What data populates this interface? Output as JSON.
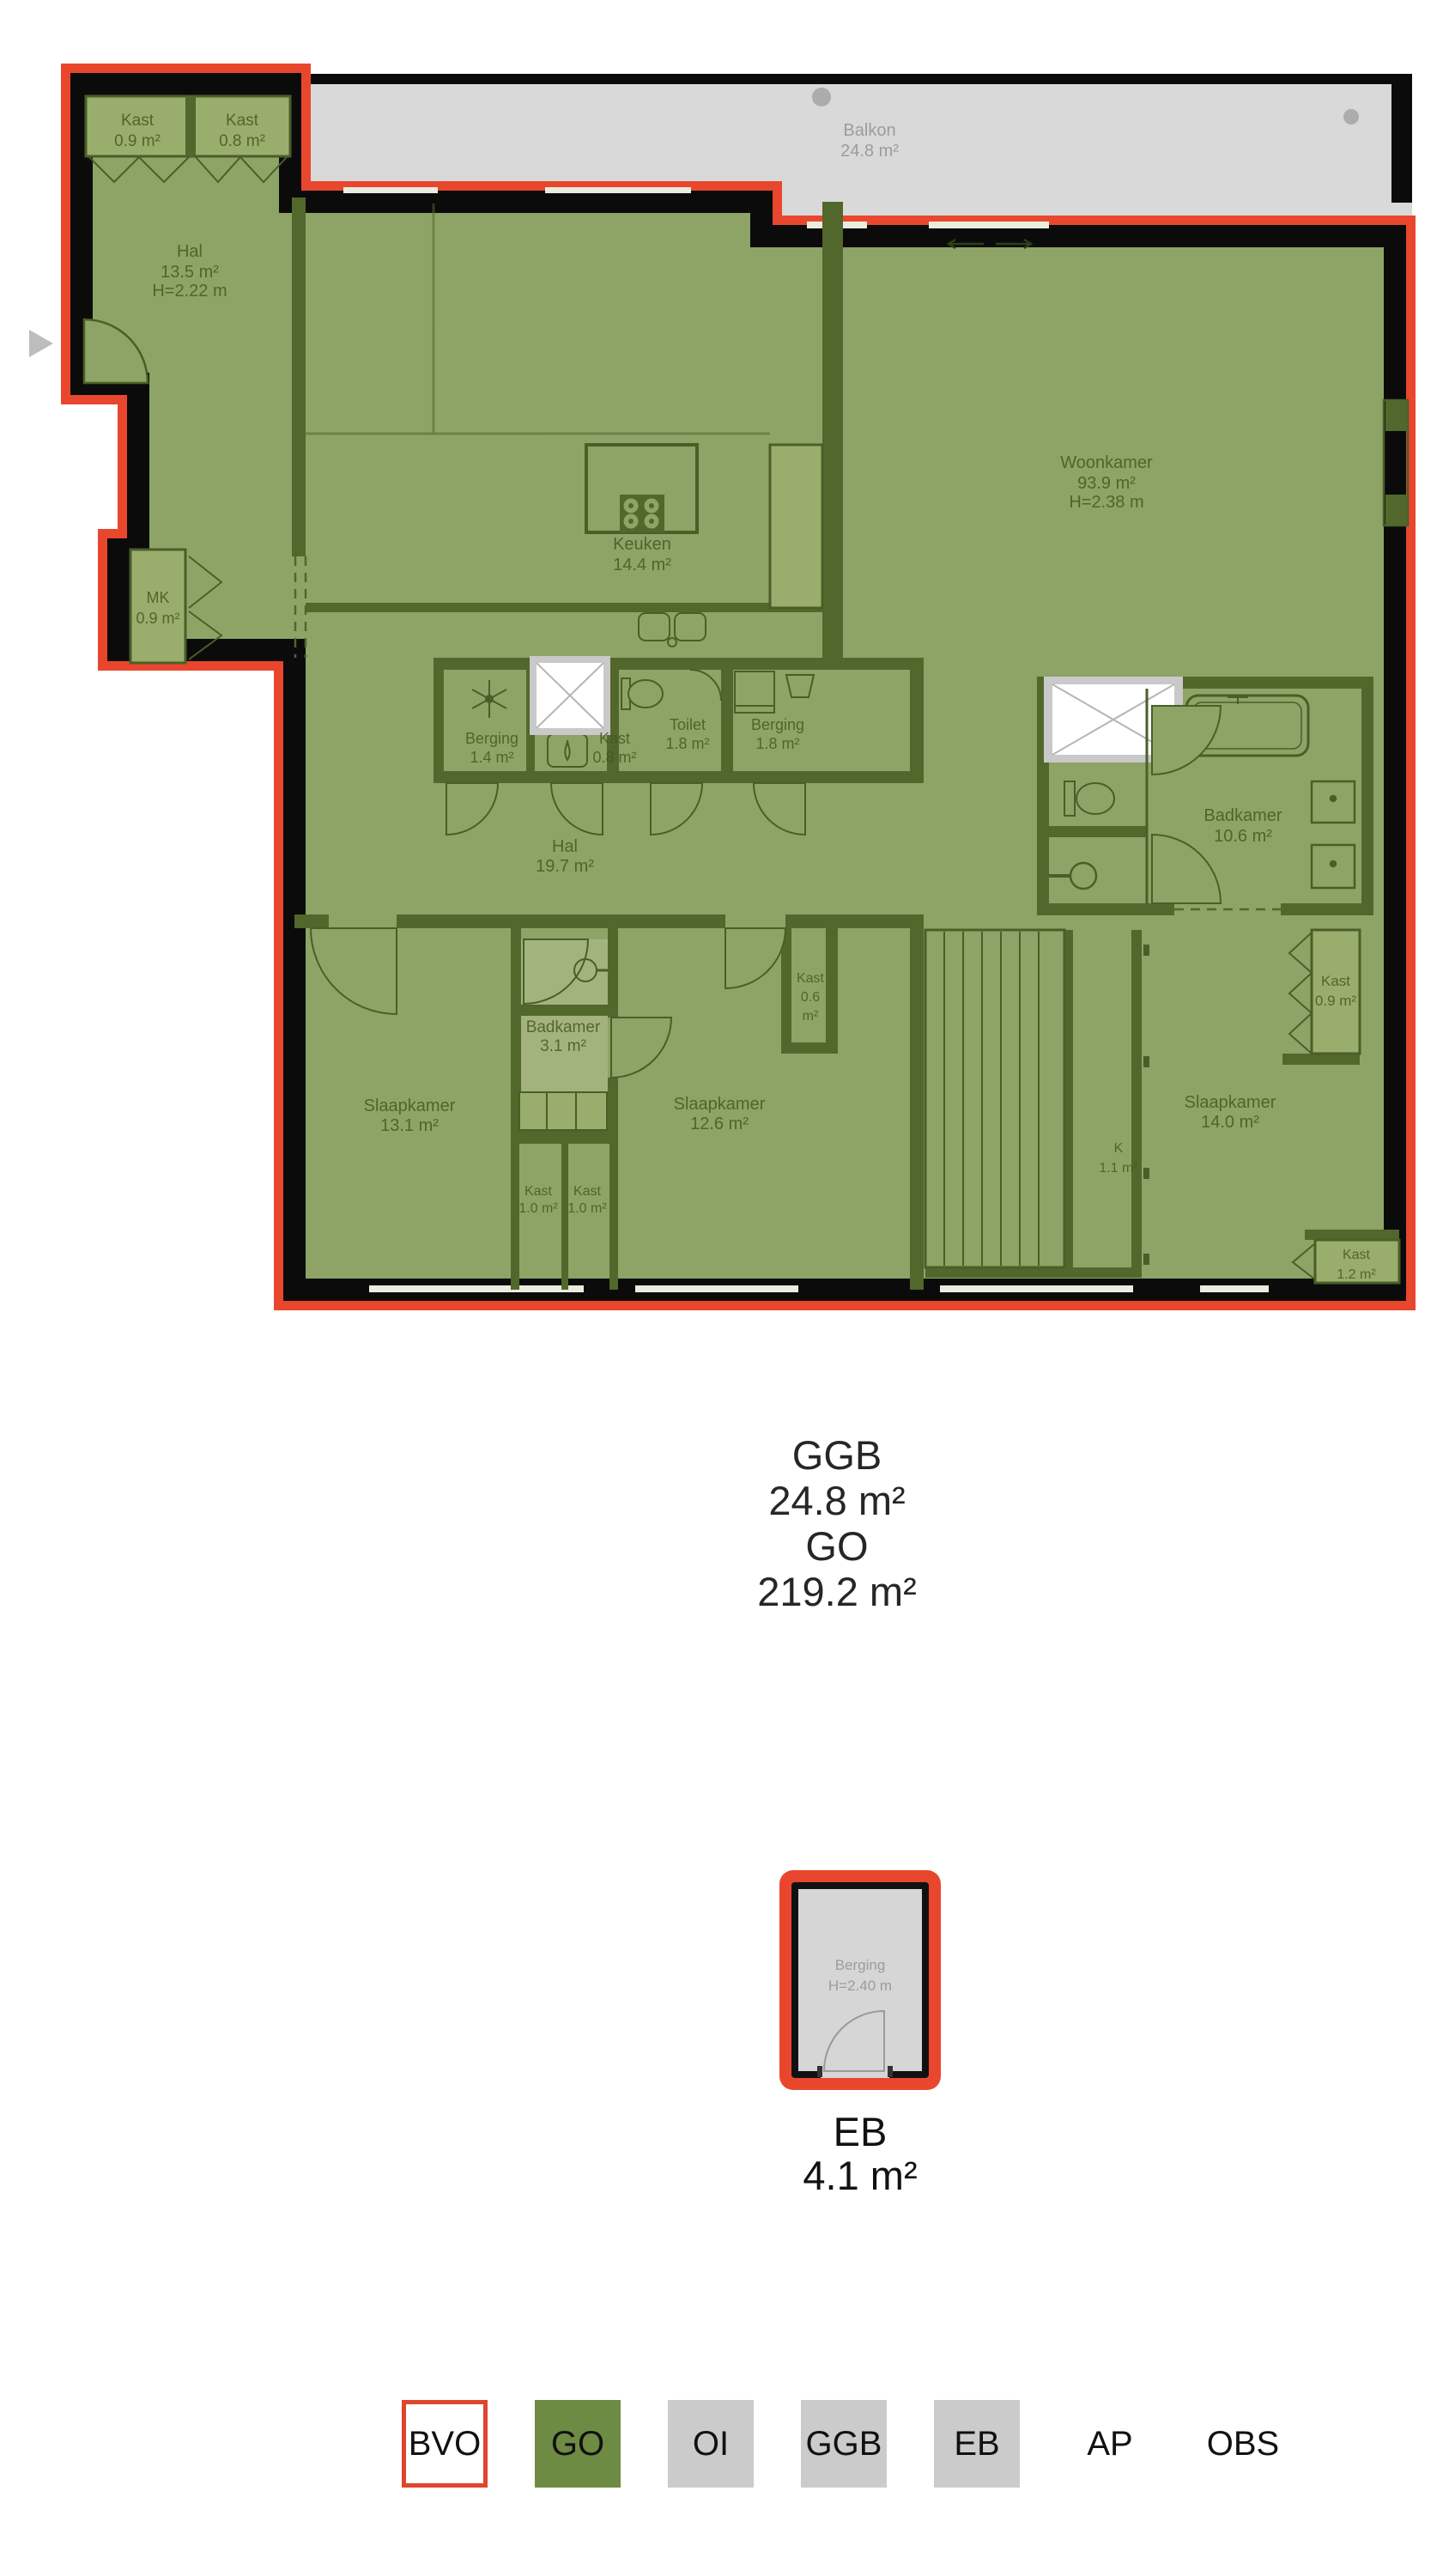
{
  "rooms": {
    "kast_tl1": {
      "name": "Kast",
      "area": "0.9 m²"
    },
    "kast_tl2": {
      "name": "Kast",
      "area": "0.8 m²"
    },
    "hal1": {
      "name": "Hal",
      "area": "13.5 m²",
      "height": "H=2.22 m"
    },
    "balkon": {
      "name": "Balkon",
      "area": "24.8 m²"
    },
    "mk": {
      "name": "MK",
      "area": "0.9 m²"
    },
    "keuken": {
      "name": "Keuken",
      "area": "14.4 m²"
    },
    "woonkamer": {
      "name": "Woonkamer",
      "area": "93.9 m²",
      "height": "H=2.38 m"
    },
    "berging14": {
      "name": "Berging",
      "area": "1.4 m²"
    },
    "kast08": {
      "name": "Kast",
      "area": "0.8 m²"
    },
    "toilet": {
      "name": "Toilet",
      "area": "1.8 m²"
    },
    "berging18": {
      "name": "Berging",
      "area": "1.8 m²"
    },
    "hal2": {
      "name": "Hal",
      "area": "19.7 m²"
    },
    "badkamer106": {
      "name": "Badkamer",
      "area": "10.6 m²"
    },
    "kast06": {
      "name": "Kast",
      "area": "0.6",
      "unit": "m²"
    },
    "badkamer31": {
      "name": "Badkamer",
      "area": "3.1 m²"
    },
    "slaapkamer131": {
      "name": "Slaapkamer",
      "area": "13.1 m²"
    },
    "slaapkamer126": {
      "name": "Slaapkamer",
      "area": "12.6 m²"
    },
    "slaapkamer140": {
      "name": "Slaapkamer",
      "area": "14.0 m²"
    },
    "k11": {
      "name": "K",
      "area": "1.1 m²"
    },
    "kast10a": {
      "name": "Kast",
      "area": "1.0 m²"
    },
    "kast10b": {
      "name": "Kast",
      "area": "1.0 m²"
    },
    "kast09r": {
      "name": "Kast",
      "area": "0.9 m²"
    },
    "kast12": {
      "name": "Kast",
      "area": "1.2 m²"
    },
    "eb_berging": {
      "name": "Berging",
      "height": "H=2.40 m"
    }
  },
  "summary": {
    "lines": [
      "GGB",
      "24.8 m²",
      "GO",
      "219.2 m²"
    ]
  },
  "eb_summary": {
    "lines": [
      "EB",
      "4.1 m²"
    ]
  },
  "legend": {
    "items": [
      {
        "label": "BVO"
      },
      {
        "label": "GO"
      },
      {
        "label": "OI"
      },
      {
        "label": "GGB"
      },
      {
        "label": "EB"
      },
      {
        "label": "AP"
      },
      {
        "label": "OBS"
      }
    ]
  },
  "colors": {
    "bvo_outline_red": "#e8472e",
    "go_green": "#8da466",
    "wall_olive": "#51672c",
    "wall_black": "#0b0b0b",
    "balcony_gray": "#d9d9d9",
    "eb_gray": "#d6d6d6",
    "legend_green": "#6e8b43",
    "legend_gray": "#cbcbcb"
  }
}
